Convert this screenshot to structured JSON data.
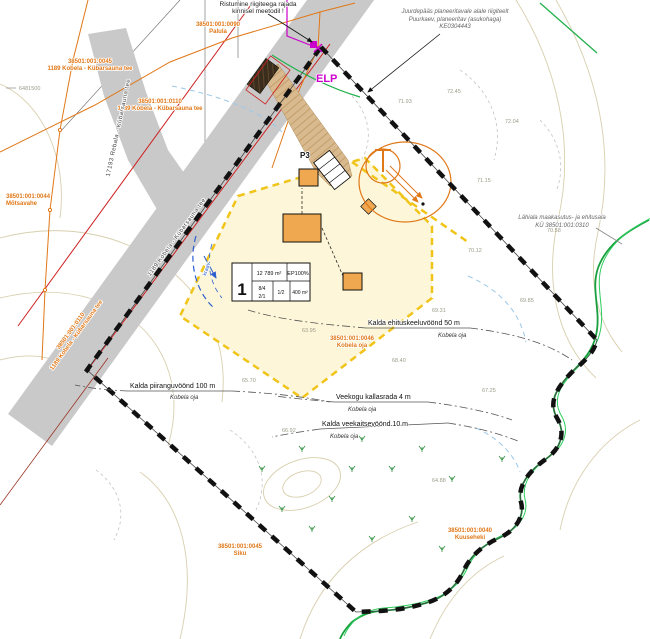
{
  "notes": {
    "top_left_1": "Ristumine riigiteega rajada",
    "top_left_2": "kinnisel meetodil !",
    "top_right_1": "Juurdepääs planeeritavale alale riigiteelt",
    "top_right_2": "Puurkaev, planeeritav (asukohaga)",
    "top_right_3": "KE0304443",
    "side_1": "Lähiala maakasutus- ja ehitusala",
    "side_2": "KÜ 38501:001:0310"
  },
  "labels": {
    "elp": "ELP",
    "parking": "P3",
    "ditch": "kraav",
    "coord": "6481500"
  },
  "pos_table": {
    "pos": "1",
    "area": "12 789 m²",
    "ep": "EP100%",
    "r1": "8/4",
    "r2": "2/1",
    "r3": "1/2",
    "r4": "400 m²"
  },
  "constraints": [
    {
      "label": "Kalda piiranguvöönd 100 m",
      "sub": "Kobela oja"
    },
    {
      "label": "Kalda ehituskeeluvöönd 50 m",
      "sub": "Kobela oja"
    },
    {
      "label": "Veekogu kallasrada 4 m",
      "sub": "Kobela oja"
    },
    {
      "label": "Kalda veekaitsevöönd 10 m",
      "sub": "Kobela oja"
    }
  ],
  "cadastral": [
    {
      "code": "38501:001:0090",
      "name": "Palula"
    },
    {
      "code": "38501:001:0045",
      "name": "1189 Kobela - Kübarsauna tee"
    },
    {
      "code": "38501:001:0110",
      "name": "1189 Kobela - Kübarsauna tee"
    },
    {
      "code": "38501:001:0110",
      "name": "1189 Kobela - Kübarsauna tee"
    },
    {
      "code": "38501:001:0044",
      "name": "Mõtsavahe"
    },
    {
      "code": "38501:001:0045",
      "name": "Siku"
    },
    {
      "code": "38501:001:0040",
      "name": "Kuuseheki"
    },
    {
      "code": "38501:001:0046",
      "name": "Kobela oja"
    }
  ],
  "roads": [
    {
      "name": "17193 Rebala - Kübarsauna tee"
    },
    {
      "name": "1189 Kobela - Kübarsauna tee"
    }
  ],
  "elevations": [
    "71.93",
    "72.45",
    "72.04",
    "71.15",
    "70.58",
    "70.12",
    "69.85",
    "69.31",
    "68.40",
    "67.25",
    "66.92",
    "65.70",
    "64.88",
    "63.95"
  ],
  "colors": {
    "boundary": "#111111",
    "plot_fill": "#fdf6d8",
    "plot_dash": "#f0c419",
    "building": "#f0a850",
    "stream": "#19a03e",
    "cadastral_text": "#e07818",
    "road_fill": "#c9c9c9",
    "road_edge": "#cc2020",
    "connection_point": "#cc00cc",
    "ditch": "#2b5fd0"
  }
}
